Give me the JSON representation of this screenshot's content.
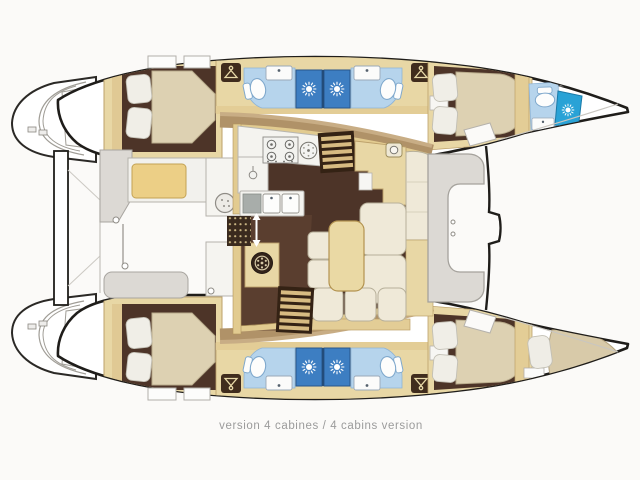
{
  "diagram": {
    "type": "catamaran-interior-floor-plan",
    "caption": "version 4 cabines / 4 cabins version"
  },
  "palette": {
    "paper": "#fbfaf8",
    "outline": "#1f1d1a",
    "floor_brown": "#4d3428",
    "furniture_beige": "#e8d7a5",
    "trim_beige": "#e2cb90",
    "deck_tan": "#b09268",
    "bath_floor_blue": "#b6d4ec",
    "shower_blue": "#3d7ec2",
    "bow_shower_blue": "#29a2d6",
    "mattress_cream": "#ddd1b2",
    "cushion_cream": "#efe9d8",
    "table_beige": "#ead9a4",
    "cockpit_cushion_yellow": "#eccf86",
    "exterior_gray": "#dcd9d4",
    "caption_gray": "#9b9b9b"
  },
  "icon_glyphs": [
    "sun-shower-drain-icon",
    "clothes-hanger-icon",
    "toilet-icon",
    "sink-faucet-icon",
    "stove-burner-icon",
    "round-burner-icon",
    "staircase-icon",
    "washing-machine-icon",
    "grill-icon",
    "sliding-door-arrows-icon"
  ],
  "areas": [
    "double-berth-cabin x4",
    "en-suite-shower-room x4",
    "bow-day-head",
    "bow-crew-berth",
    "saloon",
    "galley",
    "dinette",
    "chart-table",
    "companionway-stairs x2",
    "cockpit",
    "forward-cockpit",
    "transom-steps x2",
    "trampoline-foredeck"
  ]
}
